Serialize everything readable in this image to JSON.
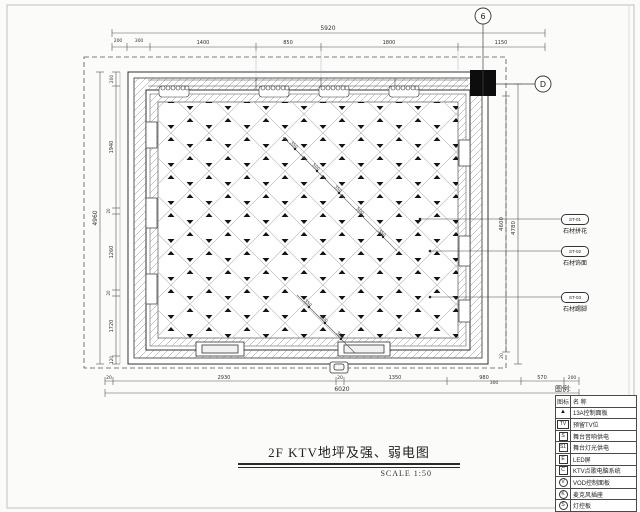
{
  "title": {
    "text": "2F KTV地坪及强、弱电图",
    "scale_label": "SCALE 1:50"
  },
  "axis": {
    "top_bubble": "6",
    "right_bubble": "D"
  },
  "dims": {
    "top_total": "5920",
    "top_segments": [
      "200",
      "300",
      "1400",
      "850",
      "1800",
      "1150"
    ],
    "bottom_total": "6020",
    "bottom_segments": [
      "20",
      "2930",
      "20",
      "1350",
      "980",
      "570",
      "200"
    ],
    "left_total": "4960",
    "left_segments": [
      "200",
      "1940",
      "20",
      "1260",
      "20",
      "1720",
      "120"
    ],
    "right_inner": "4600",
    "right_outer": "4780",
    "right_small": "20",
    "right_bottom": "300",
    "diag1": [
      "350",
      "500",
      "350",
      "500",
      "350"
    ],
    "diag2": [
      "350",
      "500",
      "350"
    ]
  },
  "callouts": [
    {
      "code": "ST-01",
      "label": "石材拼花"
    },
    {
      "code": "ST-02",
      "label": "石材饰面"
    },
    {
      "code": "ST-03",
      "label": "石材踢脚"
    }
  ],
  "legend": {
    "title": "图例:",
    "col_icon": "图标",
    "col_name": "名  称",
    "rows": [
      {
        "icon": "▲",
        "name": "13A控制面板"
      },
      {
        "icon": "TV",
        "name": "预留TV位"
      },
      {
        "icon": "S",
        "name": "舞台音响供电"
      },
      {
        "icon": "S1",
        "name": "舞台灯光供电"
      },
      {
        "icon": "E",
        "name": "LED屏"
      },
      {
        "icon": "C",
        "name": "KTV点歌电脑系统"
      },
      {
        "icon": "V",
        "name": "VOD控制面板"
      },
      {
        "icon": "K",
        "name": "麦克风插座"
      },
      {
        "icon": "S",
        "name": "灯控板"
      }
    ]
  }
}
